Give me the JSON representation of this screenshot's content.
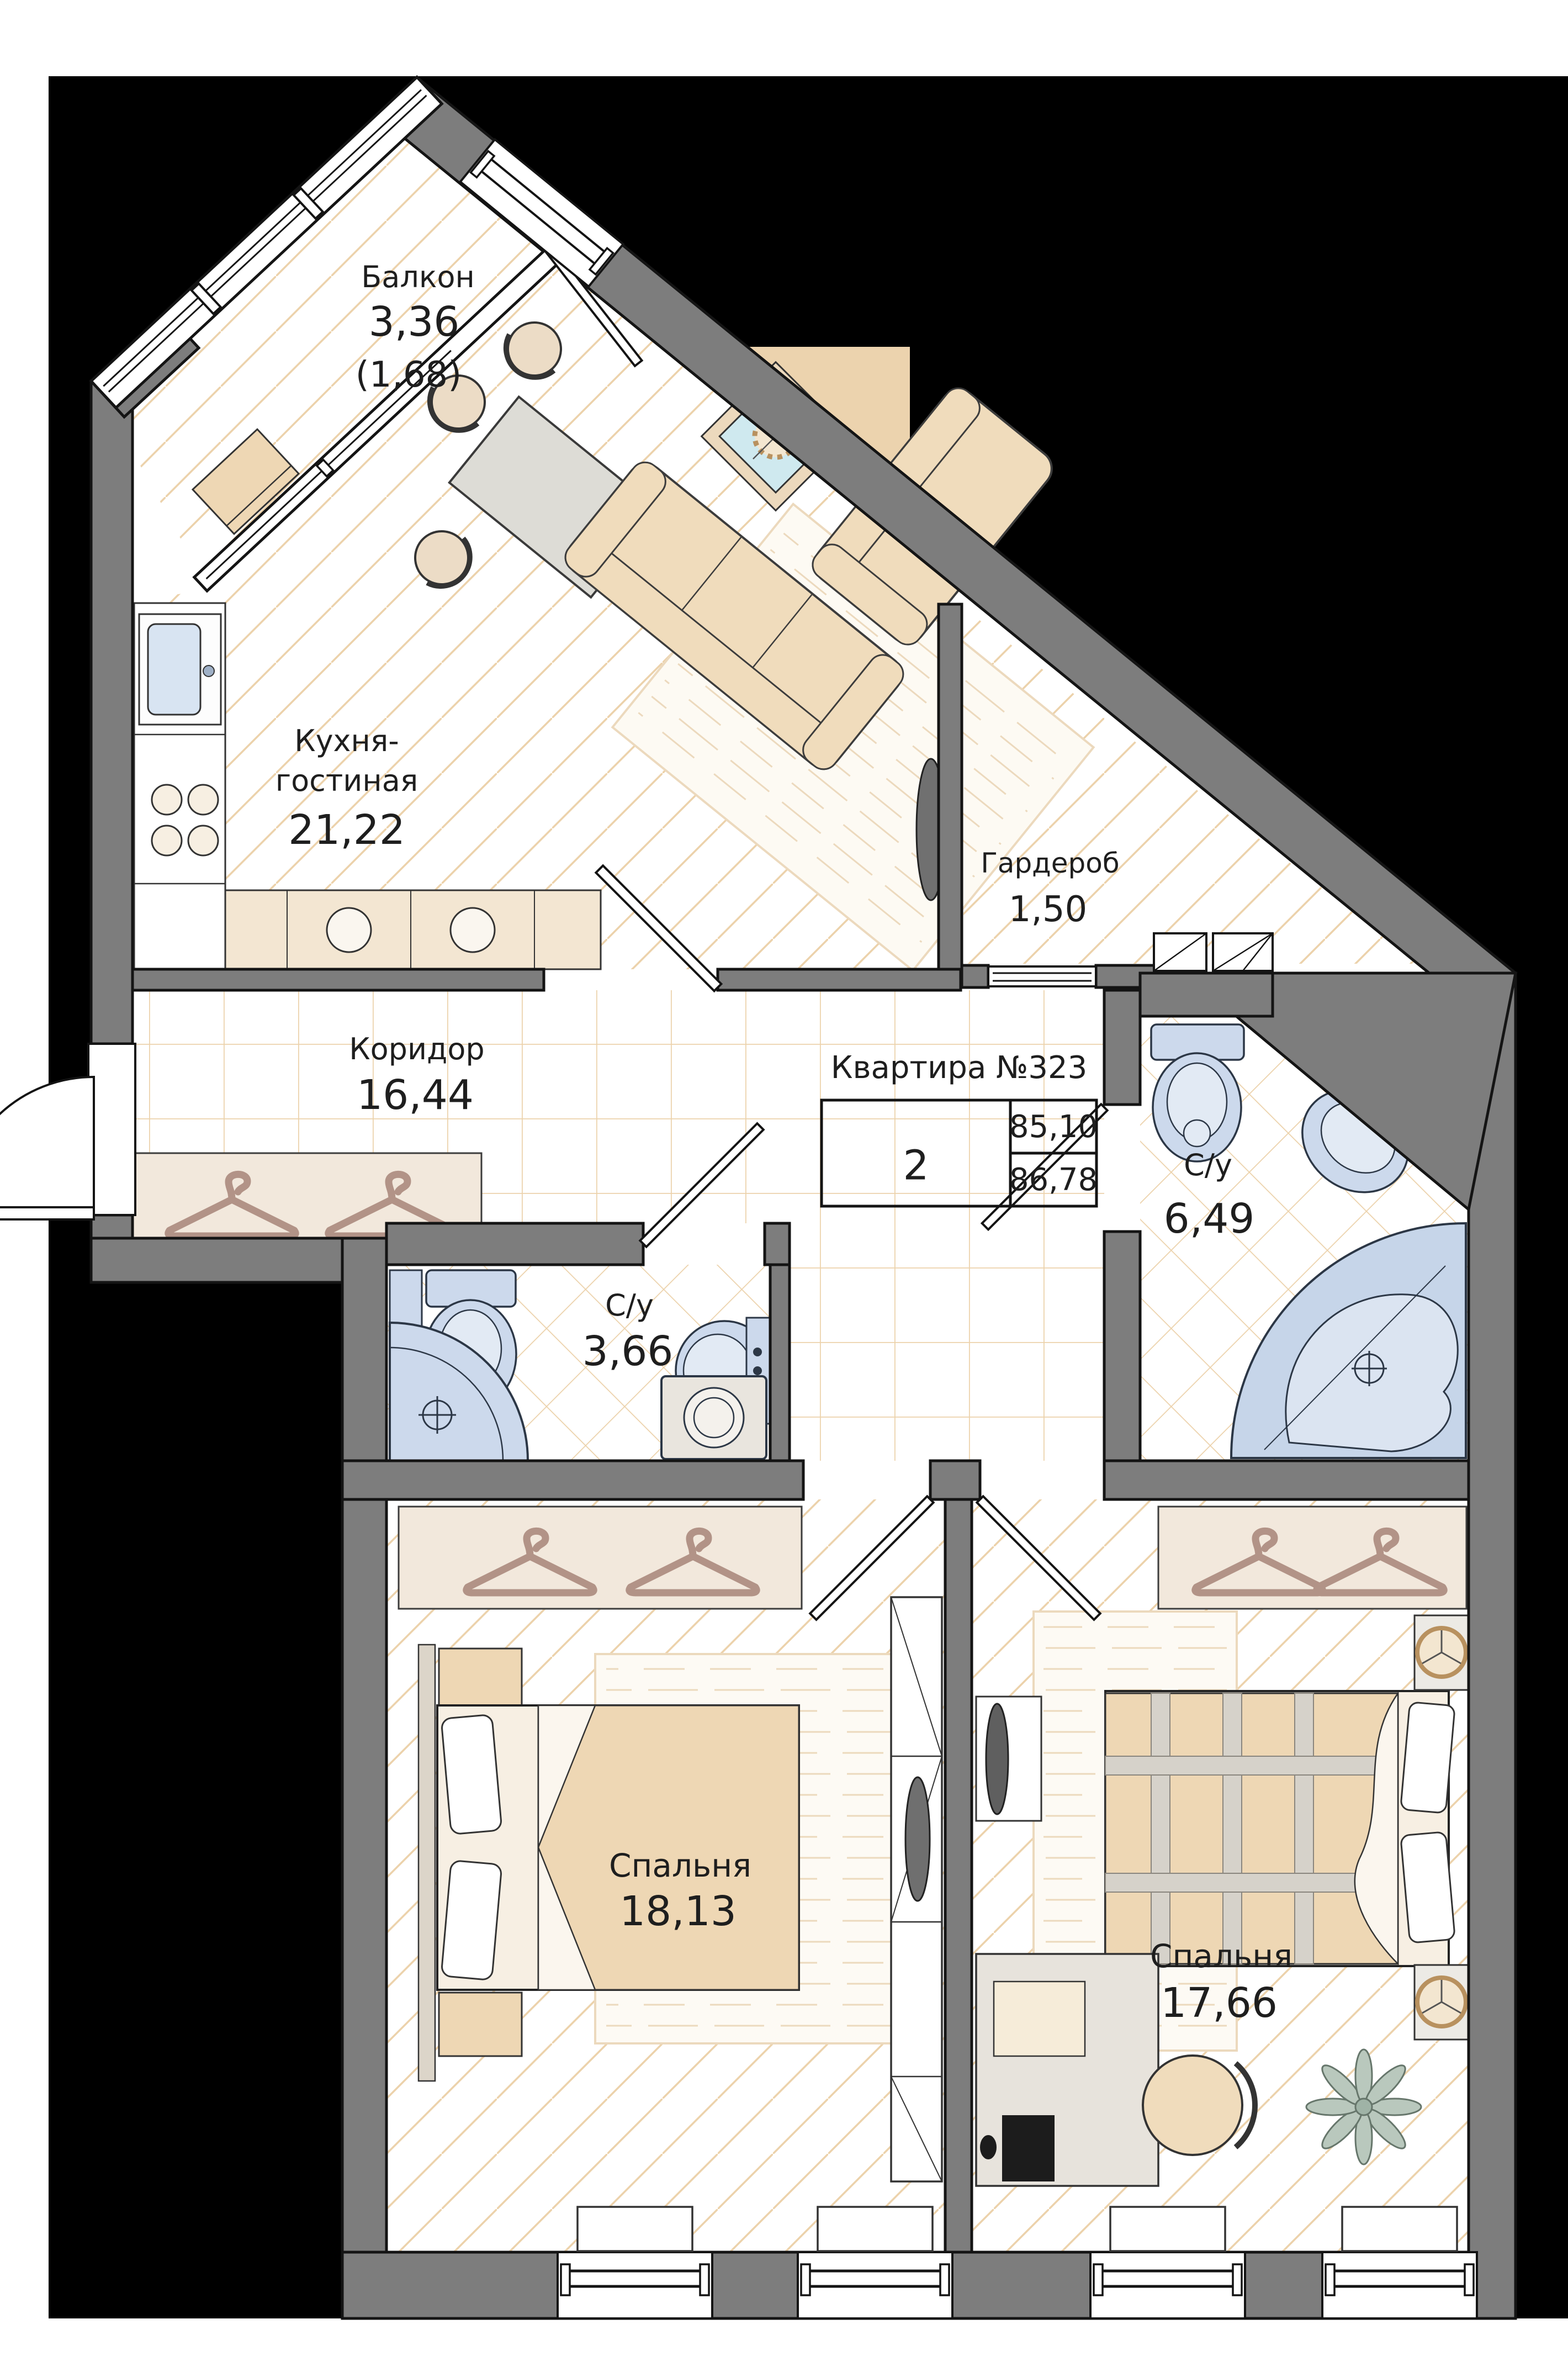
{
  "plan": {
    "apartment": {
      "title": "Квартира №323",
      "rooms_count": "2",
      "area_main": "85,10",
      "area_total": "86,78"
    },
    "rooms": {
      "balcony": {
        "name": "Балкон",
        "area": "3,36",
        "area_reduced": "(1,68)"
      },
      "kitchen_living": {
        "name_line1": "Кухня-",
        "name_line2": "гостиная",
        "area": "21,22"
      },
      "wardrobe": {
        "name": "Гардероб",
        "area": "1,50"
      },
      "corridor": {
        "name": "Коридор",
        "area": "16,44"
      },
      "bathroom_large": {
        "name": "С/у",
        "area": "6,49"
      },
      "bathroom_small": {
        "name": "С/у",
        "area": "3,66"
      },
      "bedroom_1": {
        "name": "Спальня",
        "area": "18,13"
      },
      "bedroom_2": {
        "name": "Спальня",
        "area": "17,66"
      }
    },
    "colors": {
      "outside": "#000000",
      "wall": "#7d7d7d",
      "hatch": "#ecd2ab",
      "fixture_blue": "#ccd9ec",
      "fixture_blue_light": "#e1e9f4",
      "furniture_beige": "#eed7b4",
      "wood_light": "#f2e8dc",
      "hanger_brown": "#b29387",
      "deco_blue": "#cfe9ef"
    }
  }
}
